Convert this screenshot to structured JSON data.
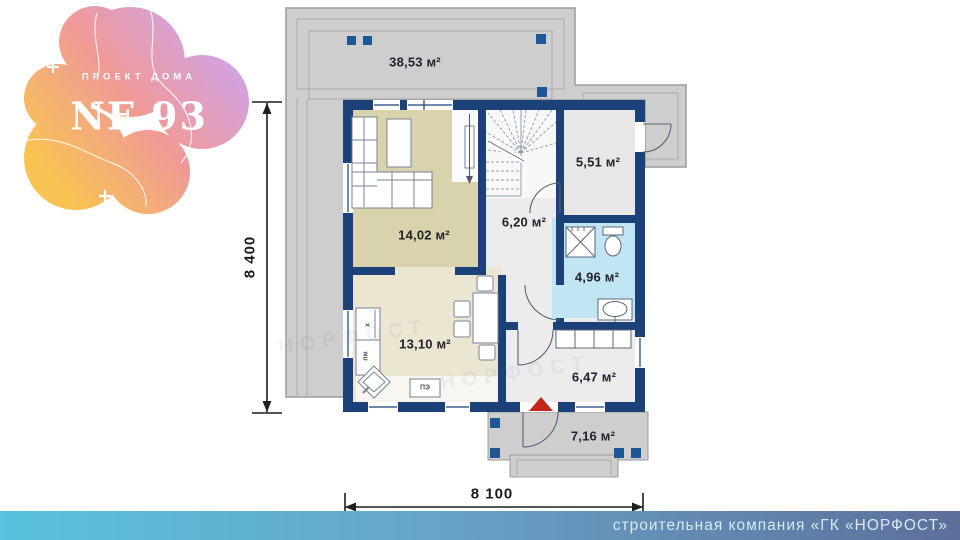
{
  "logo": {
    "kicker": "ПРОЕКТ ДОМА",
    "title": "NF 93"
  },
  "areas": {
    "terrace": "38,53 м²",
    "living": "14,02 м²",
    "stair_hall": "6,20 м²",
    "room_551": "5,51 м²",
    "bathroom": "4,96 м²",
    "kitchen": "13,10 м²",
    "entry_hall": "6,47 м²",
    "porch": "7,16 м²"
  },
  "kitchen_labels": {
    "fridge": "х",
    "dishwasher": "пм",
    "stove": "ПЭ"
  },
  "dimensions": {
    "height": "8 400",
    "width": "8 100"
  },
  "footer": {
    "company": "строительная компания «ГК «НОРФОСТ»"
  },
  "watermark": {
    "text": "НОРФОСТ"
  },
  "colors": {
    "wall": "#1b4178",
    "pillar": "#1d5796",
    "accent_red": "#c1271b",
    "terrace": "#cecece",
    "living_floor": "#d8d2ad",
    "kitchen_floor": "#eae6d2",
    "bathroom_floor": "#c2e5f4",
    "hall_floor": "#ececec",
    "footer_left": "#58c3dc",
    "footer_right": "#5d6f9b",
    "logo_yellow": "#f8c353",
    "logo_pink": "#f09a98",
    "logo_purple": "#cfa3ea"
  }
}
